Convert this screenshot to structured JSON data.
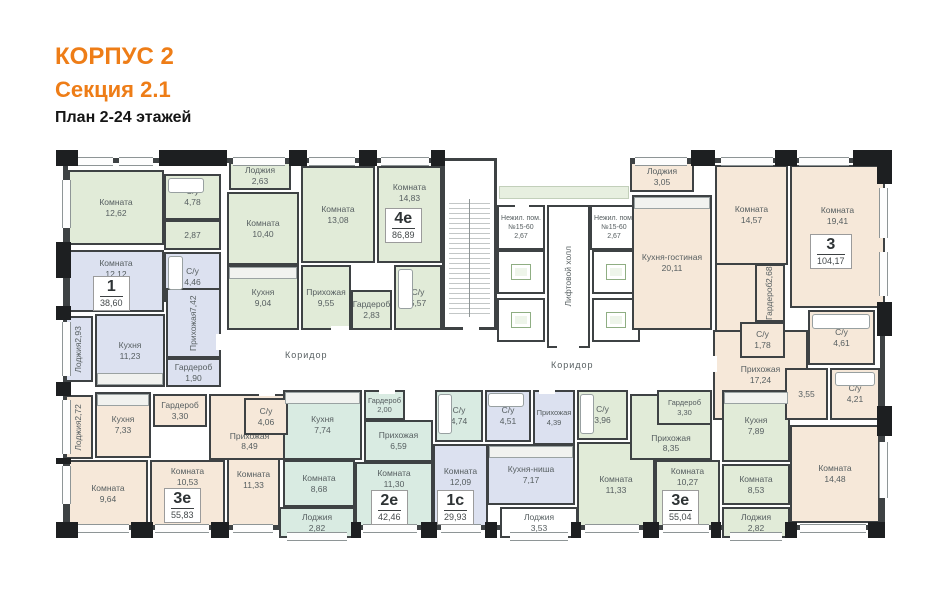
{
  "header": {
    "building": "КОРПУС 2",
    "section": "Секция 2.1",
    "plan_title": "План 2-24 этажей"
  },
  "colors": {
    "wall": "#3e4244",
    "green": "#e1ebd8",
    "mint": "#d9ebe2",
    "lavender": "#dce1f0",
    "beige": "#f6e8d9",
    "accent_orange": "#ee7d17"
  },
  "common": {
    "corridor_left": "Коридор",
    "corridor_right": "Коридор",
    "lift_hall": "Лифтовой холл",
    "nonres1": {
      "name": "Нежил. пом.",
      "number": "№15-60",
      "area": "2,67"
    },
    "nonres2": {
      "name": "Нежил. пом.",
      "number": "№15-60",
      "area": "2,67"
    }
  },
  "badges": {
    "apt1": {
      "num": "1",
      "area": "38,60"
    },
    "apt4e": {
      "num": "4е",
      "area": "86,89"
    },
    "apt3": {
      "num": "3",
      "area": "104,17"
    },
    "apt3e_left": {
      "num": "3е",
      "area": "55,83"
    },
    "apt2e": {
      "num": "2е",
      "area": "42,46"
    },
    "apt1c": {
      "num": "1с",
      "area": "29,93"
    },
    "apt3e_right": {
      "num": "3е",
      "area": "55,04"
    }
  },
  "rooms": {
    "k1262": {
      "name": "Комната",
      "area": "12,62"
    },
    "su478": {
      "name": "С/у",
      "area": "4,78"
    },
    "h287": {
      "name": "",
      "area": "2,87"
    },
    "log263": {
      "name": "Лоджия",
      "area": "2,63"
    },
    "k1040": {
      "name": "Комната",
      "area": "10,40"
    },
    "kit904": {
      "name": "Кухня",
      "area": "9,04"
    },
    "k1308": {
      "name": "Комната",
      "area": "13,08"
    },
    "k1483": {
      "name": "Комната",
      "area": "14,83"
    },
    "pri955": {
      "name": "Прихожая",
      "area": "9,55"
    },
    "gard283": {
      "name": "Гардероб",
      "area": "2,83"
    },
    "su557": {
      "name": "С/у",
      "area": "5,57"
    },
    "k1212": {
      "name": "Комната",
      "area": "12,12"
    },
    "su446": {
      "name": "С/у",
      "area": "4,46"
    },
    "kit1123": {
      "name": "Кухня",
      "area": "11,23"
    },
    "log293": {
      "name": "Лоджия",
      "area": "2,93"
    },
    "pri742": {
      "name": "Прихожая",
      "area": "7,42"
    },
    "gard190": {
      "name": "Гардероб",
      "area": "1,90"
    },
    "log272": {
      "name": "Лоджия",
      "area": "2,72"
    },
    "kit733": {
      "name": "Кухня",
      "area": "7,33"
    },
    "gard330l": {
      "name": "Гардероб",
      "area": "3,30"
    },
    "pri849": {
      "name": "Прихожая",
      "area": "8,49"
    },
    "su406": {
      "name": "С/у",
      "area": "4,06"
    },
    "k964": {
      "name": "Комната",
      "area": "9,64"
    },
    "k1053": {
      "name": "Комната",
      "area": "10,53"
    },
    "k1133l": {
      "name": "Комната",
      "area": "11,33"
    },
    "kit774": {
      "name": "Кухня",
      "area": "7,74"
    },
    "gard200": {
      "name": "Гардероб",
      "area": "2,00"
    },
    "pri659": {
      "name": "Прихожая",
      "area": "6,59"
    },
    "su474": {
      "name": "С/у",
      "area": "4,74"
    },
    "k868": {
      "name": "Комната",
      "area": "8,68"
    },
    "k1130": {
      "name": "Комната",
      "area": "11,30"
    },
    "log282a": {
      "name": "Лоджия",
      "area": "2,82"
    },
    "su451": {
      "name": "С/у",
      "area": "4,51"
    },
    "pri439": {
      "name": "Прихожая",
      "area": "4,39"
    },
    "kitn717": {
      "name": "Кухня-ниша",
      "area": "7,17"
    },
    "k1209": {
      "name": "Комната",
      "area": "12,09"
    },
    "log353": {
      "name": "Лоджия",
      "area": "3,53"
    },
    "su396": {
      "name": "С/у",
      "area": "3,96"
    },
    "pri835": {
      "name": "Прихожая",
      "area": "8,35"
    },
    "gard330r": {
      "name": "Гардероб",
      "area": "3,30"
    },
    "k1133r": {
      "name": "Комната",
      "area": "11,33"
    },
    "k1027": {
      "name": "Комната",
      "area": "10,27"
    },
    "kit789": {
      "name": "Кухня",
      "area": "7,89"
    },
    "k853": {
      "name": "Комната",
      "area": "8,53"
    },
    "log282b": {
      "name": "Лоджия",
      "area": "2,82"
    },
    "log305": {
      "name": "Лоджия",
      "area": "3,05"
    },
    "kitliv2011": {
      "name": "Кухня-гостиная",
      "area": "20,11"
    },
    "k1457": {
      "name": "Комната",
      "area": "14,57"
    },
    "k1941": {
      "name": "Комната",
      "area": "19,41"
    },
    "gard268": {
      "name": "Гардероб",
      "area": "2,68"
    },
    "su178": {
      "name": "С/у",
      "area": "1,78"
    },
    "su461": {
      "name": "С/у",
      "area": "4,61"
    },
    "pri1724": {
      "name": "Прихожая",
      "area": "17,24"
    },
    "h355": {
      "name": "",
      "area": "3,55"
    },
    "su421": {
      "name": "С/у",
      "area": "4,21"
    },
    "k1448": {
      "name": "Комната",
      "area": "14,48"
    }
  }
}
